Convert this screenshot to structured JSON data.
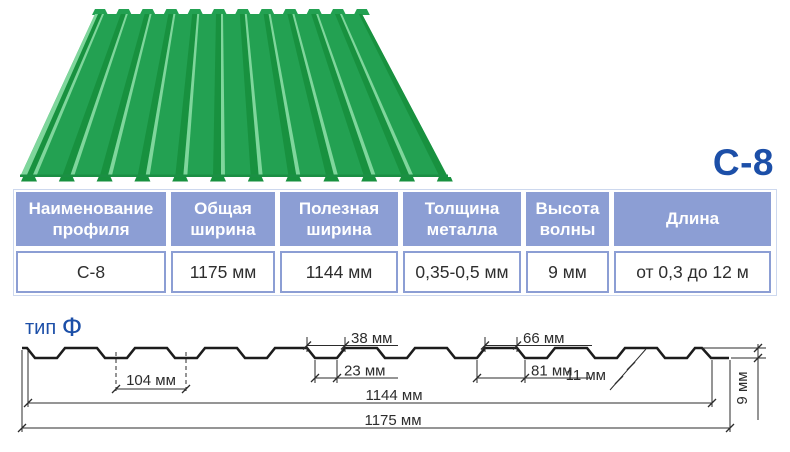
{
  "title": "С-8",
  "spec_table": {
    "columns": [
      {
        "header": "Наименование профиля",
        "value": "С-8"
      },
      {
        "header": "Общая ширина",
        "value": "1175 мм"
      },
      {
        "header": "Полезная ширина",
        "value": "1144 мм"
      },
      {
        "header": "Толщина металла",
        "value": "0,35-0,5 мм"
      },
      {
        "header": "Высота волны",
        "value": "9 мм"
      },
      {
        "header": "Длина",
        "value": "от 0,3 до 12 м"
      }
    ]
  },
  "profile_drawing": {
    "type_label": "тип",
    "type_value": "Ф",
    "dim_rib_top_width": "38 мм",
    "dim_rib_bottom_width": "23 мм",
    "dim_flat_width": "66 мм",
    "dim_rib_pitch_bottom": "81 мм",
    "dim_rib_pitch": "104 мм",
    "dim_edge": "11 мм",
    "dim_useful_width": "1144 мм",
    "dim_overall_width": "1175 мм",
    "dim_height": "9 мм"
  },
  "colors": {
    "accent_blue": "#1c4fa8",
    "table_header_bg": "#8c9ed4",
    "sheet_green": "#23a152",
    "sheet_green_dark": "#18913f",
    "sheet_green_light": "#7fd69c"
  }
}
